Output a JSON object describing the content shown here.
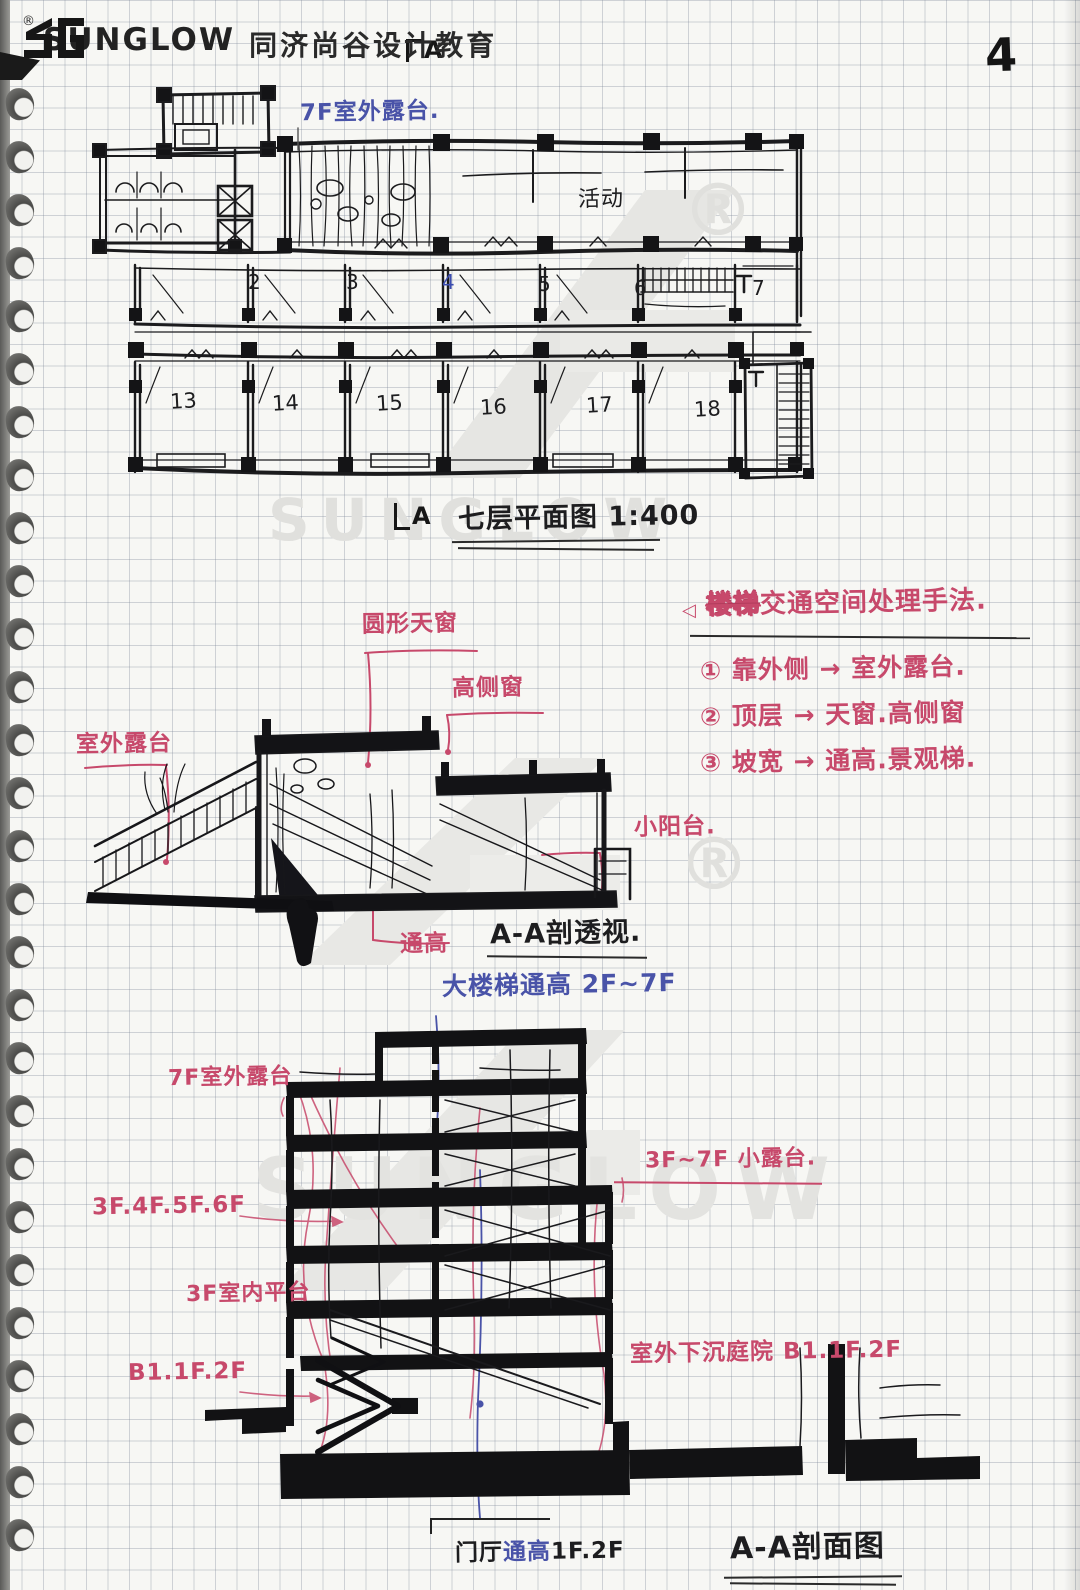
{
  "header": {
    "brand": "SUNGLOW",
    "registered": "®",
    "subtitle": "同济尚谷设计教育",
    "page_number": "4"
  },
  "watermark": {
    "brand": "SUNGLOW",
    "registered": "®"
  },
  "plan": {
    "cut_letter": "A",
    "terrace_note": "7F室外露台.",
    "activity_label": "活动",
    "rooms_mid": [
      "2",
      "3",
      "4",
      "5",
      "6",
      "7"
    ],
    "rooms_bottom": [
      "13",
      "14",
      "15",
      "16",
      "17",
      "18"
    ],
    "title": "七层平面图 1:400"
  },
  "methods": {
    "bullet": "◁",
    "heading_scribble": "楼梯",
    "heading": "交通空间处理手法.",
    "items": [
      "① 靠外侧 → 室外露台.",
      "② 顶层 → 天窗.高侧窗",
      "③ 坡宽 → 通高.景观梯."
    ]
  },
  "perspective": {
    "skylight": "圆形天窗",
    "high_window": "高侧窗",
    "terrace": "室外露台",
    "balcony": "小阳台.",
    "atrium": "通高",
    "title": "A-A剖透视."
  },
  "section": {
    "stair_atrium": "大楼梯通高 2F~7F",
    "terrace_7f": "7F室外露台",
    "small_terrace": "3F~7F 小露台.",
    "floors": "3F.4F.5F.6F",
    "platform_3f": "3F室内平台",
    "b1": "B1.1F.2F",
    "sunken": "室外下沉庭院 B1.1F.2F",
    "hall_atrium_parts": [
      "门厅",
      "通高",
      "1F.2F"
    ],
    "title": "A-A剖面图"
  }
}
